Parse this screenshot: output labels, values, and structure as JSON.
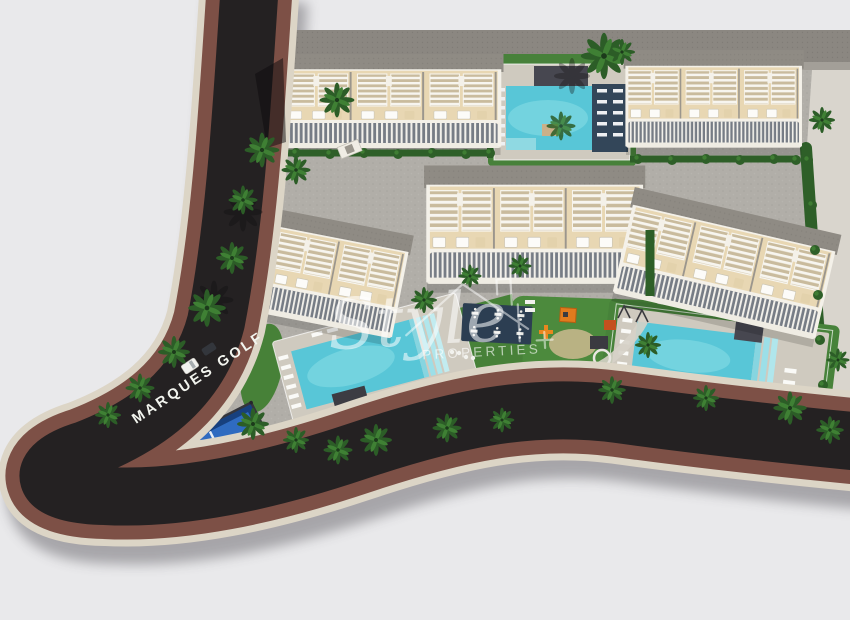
{
  "scene": {
    "description": "Aerial 3D architectural render of a residential complex site plan beside Marques Golf street",
    "street_label": "MARQUES GOLF",
    "watermark": {
      "script_word": "Style",
      "caps_word": "PROPERTIES"
    }
  },
  "palette": {
    "background": "#e9e9eb",
    "asphalt": "#242122",
    "sidewalk_brown": "#7d5046",
    "curb_cream": "#dcd5c6",
    "pavement": "#b1aea8",
    "walkway_gray": "#8b8781",
    "grass": "#4c8a3d",
    "hedge": "#2e5f28",
    "palm_dark": "#2c5d27",
    "palm_light": "#3f8034",
    "building_wall": "#e8d7b3",
    "building_trim": "#f4f1e9",
    "roof_gray": "#8f8b84",
    "railing_gray": "#767c85",
    "pool_water": "#58c6d7",
    "pool_highlight": "#7fd8e2",
    "pool_deck": "#cfcabf",
    "navy_deck": "#334659",
    "court_blue": "#2f6bc0",
    "court_frame": "#17407e",
    "playground_mat_blue": "#2a78bd",
    "playground_orange": "#e8871f"
  },
  "features": {
    "building_blocks": 5,
    "swimming_pools": 3,
    "padel_courts": 1,
    "playgrounds": 2,
    "outdoor_table_area": 1
  }
}
